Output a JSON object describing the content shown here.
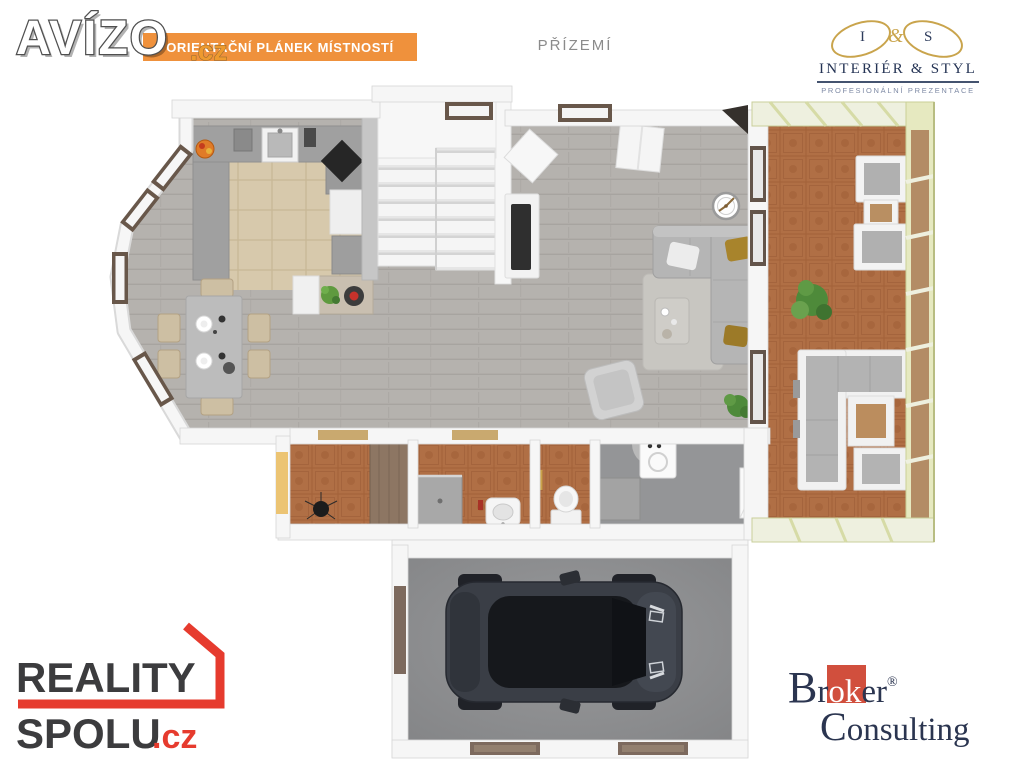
{
  "header": {
    "avizo_logo": {
      "text": "AVÍZO",
      "suffix": ".cz"
    },
    "banner": {
      "label": "ORIENTAČNÍ PLÁNEK MÍSTNOSTÍ"
    },
    "floor_label": "PŘÍZEMÍ",
    "interier_styl": {
      "monogram_i": "I",
      "monogram_amp": "&",
      "monogram_s": "S",
      "name": "INTERIÉR & STYL",
      "tagline": "PROFESIONÁLNÍ PREZENTACE"
    }
  },
  "footer": {
    "reality_spolu": {
      "word1": "REALITY",
      "word2": "SPOLU",
      "tld": ".cz"
    },
    "broker_consulting": {
      "b": "B",
      "r": "r",
      "ok": "ok",
      "er": "er",
      "reg": "®",
      "c": "C",
      "rest": "onsulting"
    }
  },
  "colors": {
    "banner_orange": "#ef913c",
    "avizo_cz_orange": "#ee9a2e",
    "reality_red": "#e63b2e",
    "broker_red": "#d14f3d",
    "brand_navy": "#2b3550",
    "monogram_gold": "#c9a44c",
    "floor_label_gray": "#8b8b8b",
    "wall_white": "#f6f6f6",
    "floor_wood_gray": "#b5b2ae",
    "kitchen_tile_beige": "#d7c9ac",
    "terracotta_tile": "#b06f45",
    "garage_floor_gray": "#8d8e90",
    "conservatory_glass_frame": "#e6e9c0",
    "sofa_gray": "#b5b5b5",
    "pillow_mustard": "#a8842c",
    "window_frame_brown": "#68574a",
    "wardrobe_brown": "#8d7663",
    "car_body_dark": "#3a3e46",
    "entry_door_yellow": "#ecc473"
  }
}
